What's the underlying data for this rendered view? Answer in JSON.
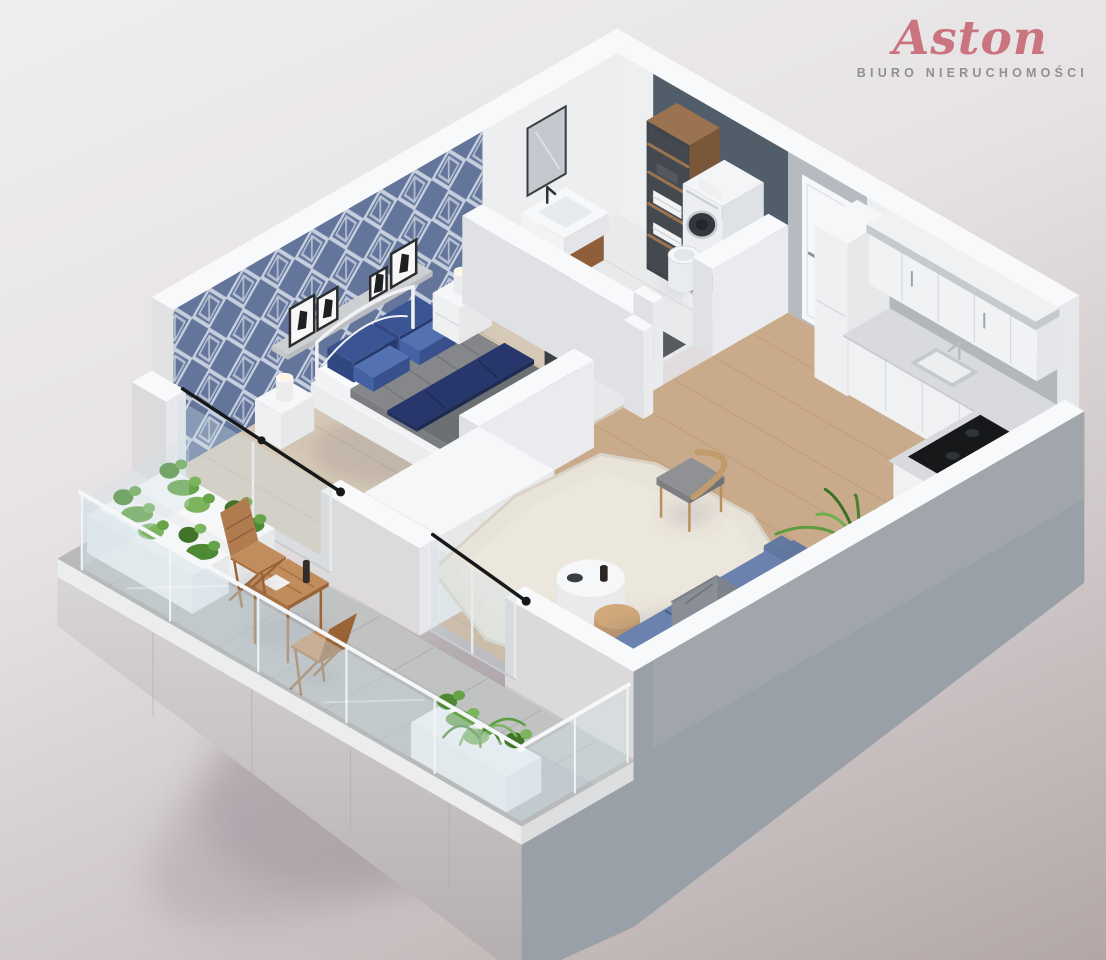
{
  "brand": {
    "name": "Aston",
    "tagline": "BIURO NIERUCHOMOŚCI"
  },
  "scene": {
    "description": "3D isometric cutaway floor plan rendering of a one-bedroom apartment with balcony",
    "rooms": [
      "bedroom",
      "bathroom",
      "hallway",
      "kitchen",
      "living-room",
      "balcony"
    ],
    "colors": {
      "brand_pink": "#c9747e",
      "tagline_gray": "#8f8f94",
      "wall_top": "#f8f9fb",
      "wall_end": "#e6e7ea",
      "wall_inner": "#edeff1",
      "wall_inner_sw": "#dfe1e4",
      "wall_face_gray": "#9aa0a7",
      "door_zone_gray": "#b6bbc1",
      "wallpaper_blue": "#64759b",
      "wallpaper_lattice": "#dfe6ef",
      "slate_panel": "#525d6a",
      "wood_floor": "#c9ab8b",
      "wood_floor_line": "#b8987a",
      "bedroom_floor": "#d6c9b7",
      "bedroom_floor_line": "#c6b59f",
      "bathroom_floor": "#e9eaec",
      "balcony_floor": "#b7b9ba",
      "rug": "#e8e3d9",
      "sofa_blue": "#5d74a4",
      "sofa_blue_dark": "#4c5f8e",
      "sofa_seat": "#6c82ae",
      "pillow_navy": "#31477f",
      "pillow_blue": "#4563a4",
      "duvet_gray": "#85878b",
      "duvet_dark": "#5a5c61",
      "navy_throw": "#27376b",
      "wood_furniture": "#b07c4f",
      "wood_furniture_dark": "#9a6437",
      "wood_cabinet": "#9c6f4c",
      "plant_green": "#5d9c3f",
      "cooktop_black": "#17181a",
      "glass_tint": "#cfe0e6",
      "door_white": "#f6f7f9",
      "counter_gray": "#d8dadd",
      "metal_dark": "#2f3237",
      "washer_door": "#34383e"
    }
  }
}
